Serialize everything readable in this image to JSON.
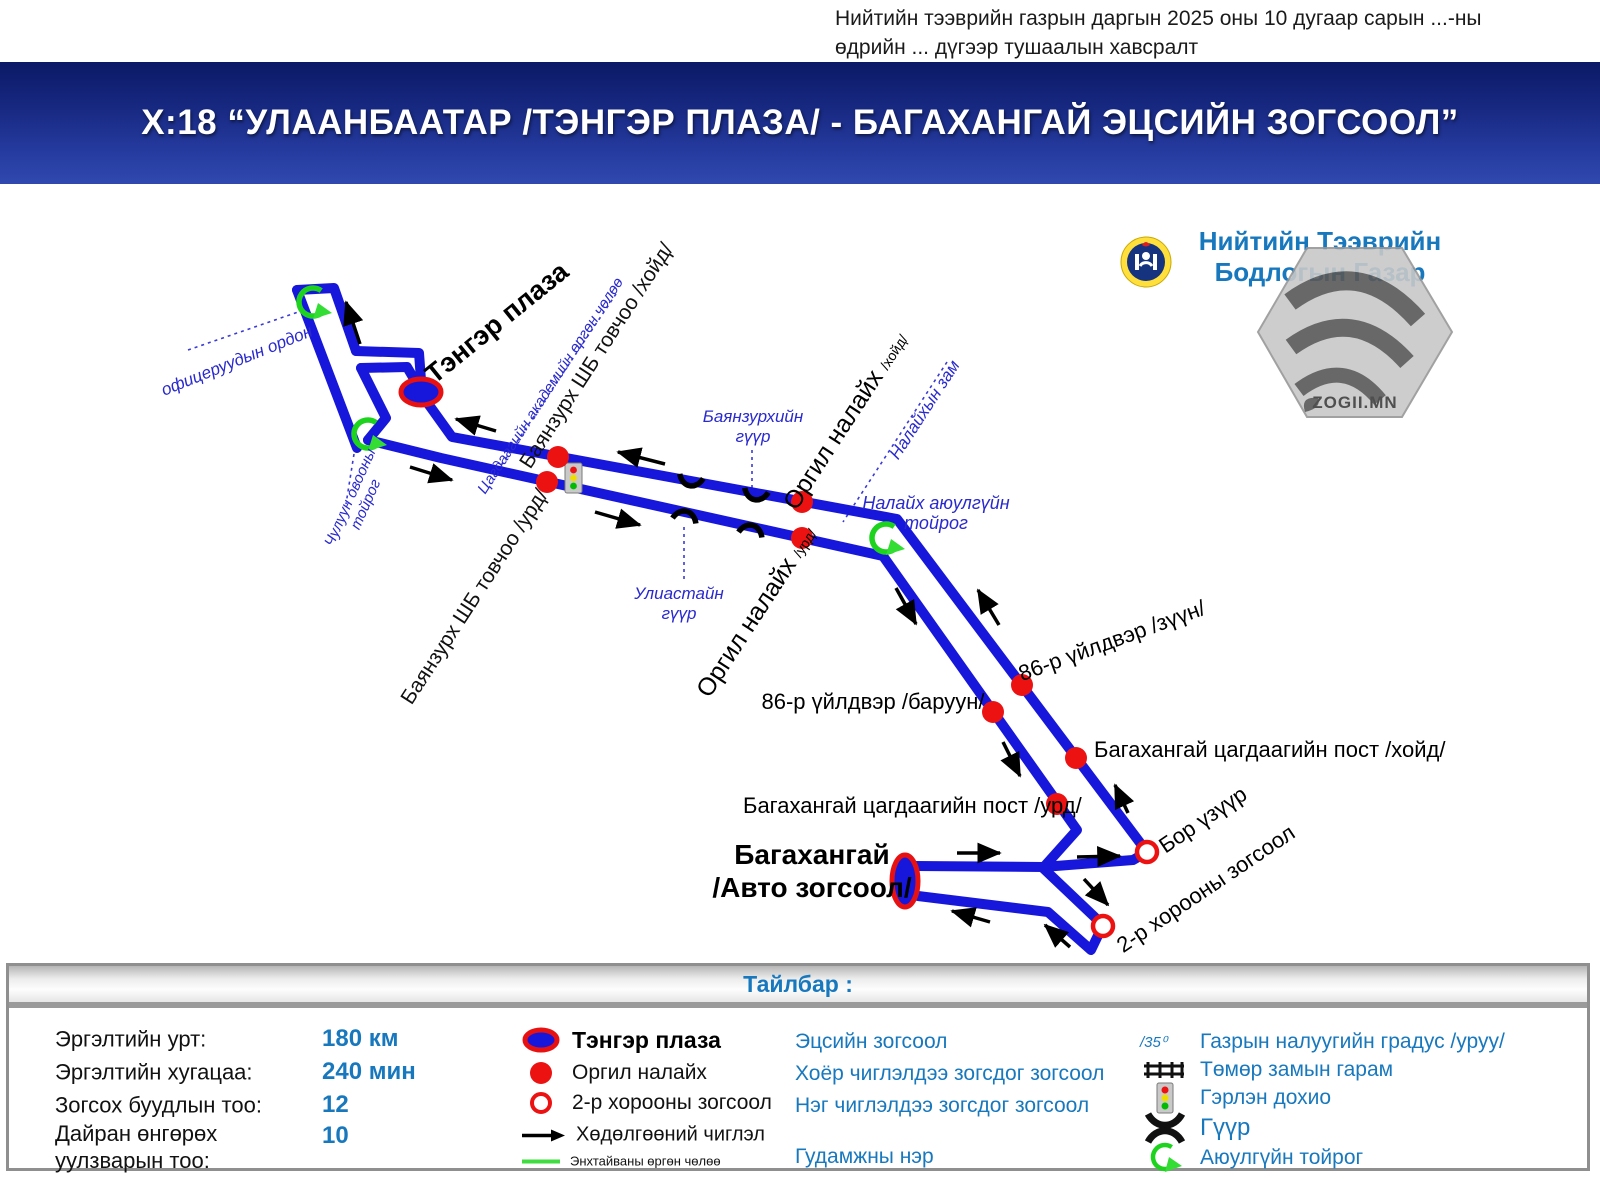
{
  "annotation": {
    "line1": "Нийтийн тээврийн газрын даргын 2025 оны 10 дугаар сарын ...-ны",
    "line2": "өдрийн ... дүгээр тушаалын хавсралт"
  },
  "title": "Х:18 “УЛААНБААТАР /ТЭНГЭР ПЛАЗА/ - БАГАХАНГАЙ ЭЦСИЙН ЗОГСООЛ”",
  "org": {
    "line1": "Нийтийн Тээврийн",
    "line2": "Бодлогын Газар"
  },
  "watermark": {
    "text": "ZOGII.MN"
  },
  "map": {
    "terminals": {
      "tenger_plaza": "Тэнгэр плаза",
      "bagakhangai_line1": "Багахангай",
      "bagakhangai_line2": "/Авто зогсоол/"
    },
    "stops": {
      "bz_khoid": "Баянзурх ШБ товчоо /хойд/",
      "bz_urd": "Баянзурх ШБ товчоо /урд/",
      "orgil": "Оргил налайх",
      "orgil_khoid_suffix": "/хойд/",
      "orgil_urd_suffix": "/урд/",
      "f86_zuun": "86-р үйлдвэр /зүүн/",
      "f86_baruun": "86-р үйлдвэр /баруун/",
      "post_khoid": "Багахангай цагдаагийн пост /хойд/",
      "post_urd": "Багахангай цагдаагийн пост /урд/",
      "bor_uzuur": "Бор үзүүр",
      "khoroo2": "2-р хорооны зогсоол"
    },
    "roads": {
      "ofitser": "офицеруудын ордон",
      "chuluun_line1": "Чулуун овооны",
      "chuluun_line2": "тойрог",
      "tsagdaa": "Цагдаагийн академийн өргөн чөлөө",
      "bz_guur_line1": "Баянзурхийн",
      "bz_guur_line2": "гүүр",
      "uliastai_line1": "Улиастайн",
      "uliastai_line2": "гүүр",
      "nalaikh_zam": "Налайхын зам",
      "nalaikh_toirog_line1": "Налайх аюулгүйн",
      "nalaikh_toirog_line2": "тойрог"
    }
  },
  "legend": {
    "header": "Тайлбар :",
    "stats": [
      {
        "label": "Эргэлтийн урт:",
        "value": "180 км"
      },
      {
        "label": "Эргэлтийн хугацаа:",
        "value": "240 мин"
      },
      {
        "label": "Зогсох буудлын тоо:",
        "value": "12"
      },
      {
        "label": "Дайран өнгөрөх",
        "label2": "уулзварын тоо:",
        "value": "10"
      }
    ],
    "symbols": {
      "terminal": "Тэнгэр плаза",
      "two_dir": "Оргил налайх",
      "one_dir": "2-р хорооны зогсоол",
      "direction": "Хөдөлгөөний чиглэл",
      "green_road": "Энхтайваны өргөн чөлөө"
    },
    "meanings": {
      "terminal": "Эцсийн зогсоол",
      "two_dir": "Хоёр чиглэлдээ зогсдог зогсоол",
      "one_dir": "Нэг чиглэлдээ зогсдог зогсоол",
      "street": "Гудамжны нэр"
    },
    "icons": {
      "slope_symbol": "/35⁰",
      "slope": "Газрын налуугийн градус /уруу/",
      "railroad": "Төмөр замын гарам",
      "traffic_light": "Гэрлэн дохио",
      "bridge": "Гүүр",
      "roundabout": "Аюулгүйн тойрог"
    }
  }
}
